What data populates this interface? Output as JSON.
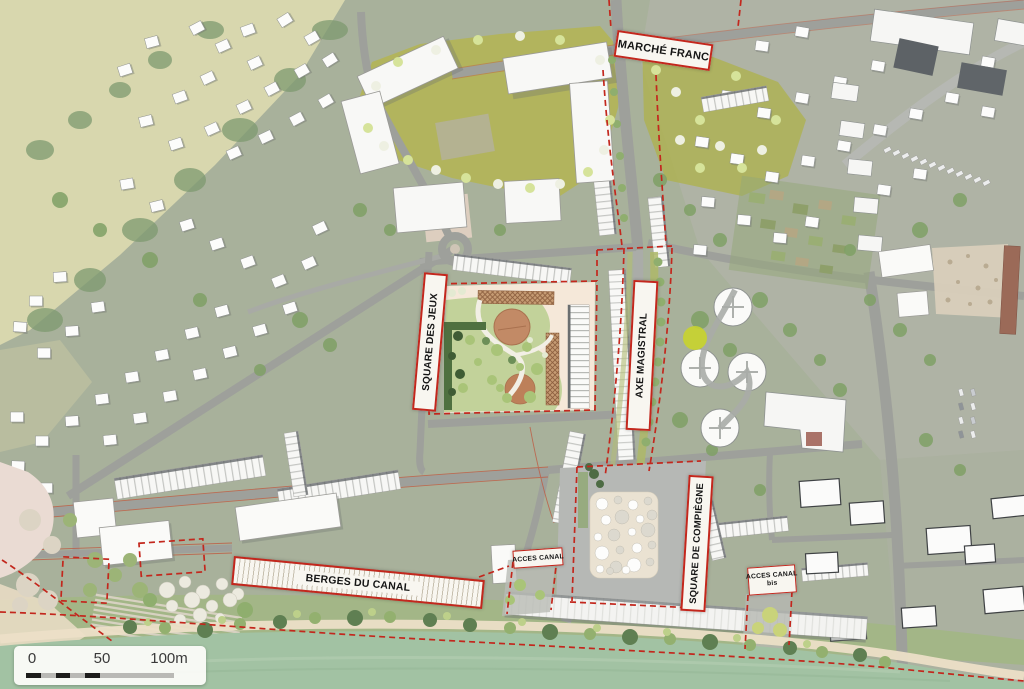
{
  "map": {
    "zone_labels": {
      "marche_franc": "MARCHÉ FRANC",
      "square_des_jeux": "SQUARE DES JEUX",
      "axe_magistral": "AXE MAGISTRAL",
      "square_de_compiegne": "SQUARE DE COMPIÈGNE",
      "berges_du_canal": "BERGES DU CANAL",
      "acces_canal": "ACCES CANAL",
      "acces_canal_bis_line1": "ACCES CANAL",
      "acces_canal_bis_line2": "bis"
    },
    "scale_bar": {
      "tick_0": "0",
      "tick_50": "50",
      "tick_100": "100m"
    },
    "colors": {
      "boundary_red": "#c3271d",
      "label_background": "#f8f6f0",
      "water_green": "#a2c2a3",
      "masterplan_olive": "#b2b557",
      "plaza_cream": "#f5e8d9",
      "terracotta": "#c28a66"
    }
  }
}
